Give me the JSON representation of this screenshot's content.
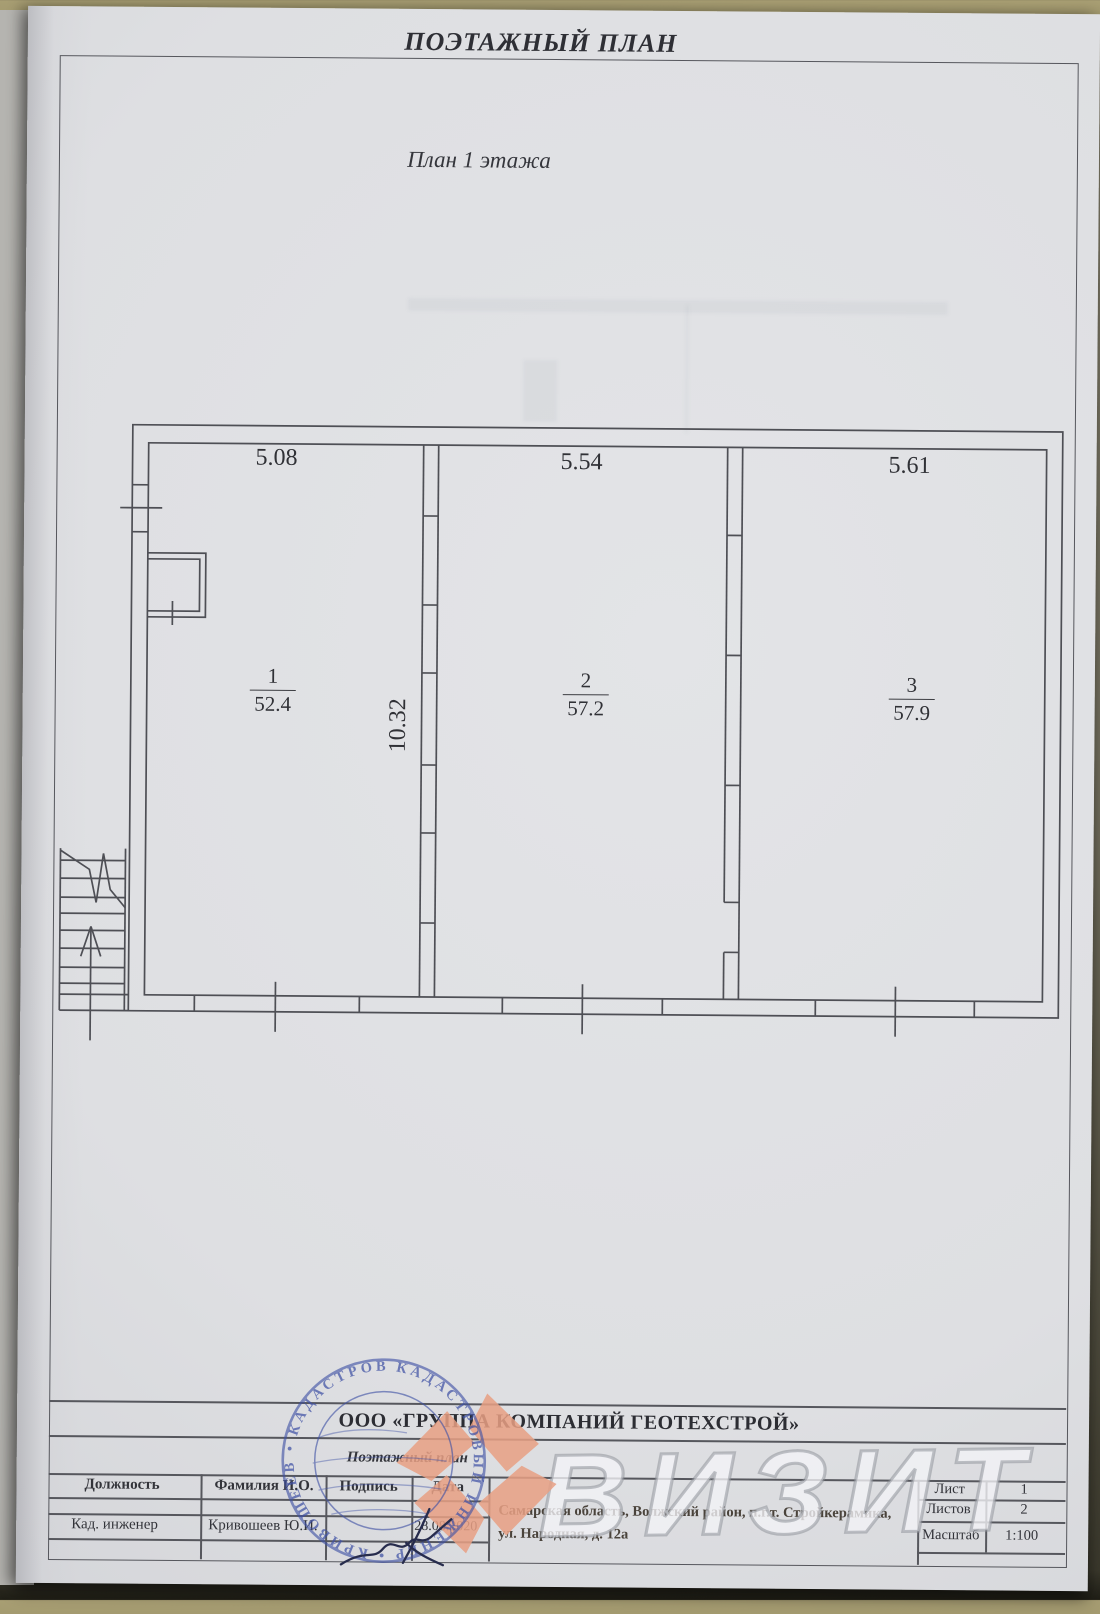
{
  "document": {
    "header_title": "ПОЭТАЖНЫЙ ПЛАН",
    "plan_caption": "План 1 этажа"
  },
  "plan": {
    "depth_dim": "10.32",
    "rooms": [
      {
        "number": "1",
        "area": "52.4",
        "width_dim": "5.08"
      },
      {
        "number": "2",
        "area": "57.2",
        "width_dim": "5.54"
      },
      {
        "number": "3",
        "area": "57.9",
        "width_dim": "5.61"
      }
    ]
  },
  "title_block": {
    "company": "ООО «ГРУППА КОМПАНИЙ ГЕОТЕХСТРОЙ»",
    "doc_type": "Поэтажный план",
    "columns": {
      "position": "Должность",
      "name": "Фамилия И.О.",
      "signature": "Подпись",
      "date": "Дата"
    },
    "row": {
      "position": "Кад. инженер",
      "name": "Кривошеев Ю.И.",
      "date": "28.08.2020"
    },
    "address_line1": "Самарская область, Волжский район, п.г.т. Стройкерамика,",
    "address_line2": "ул. Народная, д. 12а",
    "sheet": {
      "list_label": "Лист",
      "list_value": "1",
      "listov_label": "Листов",
      "listov_value": "2",
      "scale_label": "Масштаб",
      "scale_value": "1:100"
    }
  },
  "stamp": {
    "ring_text": "КАДАСТРОВЫЙ ИНЖЕНЕР • КРИВОШЕЕВ • КАДАСТРОВЫЙ •",
    "color": "#3f51a5"
  },
  "watermark": {
    "text": "ВИЗИТ",
    "logo_color": "#e8a084"
  }
}
